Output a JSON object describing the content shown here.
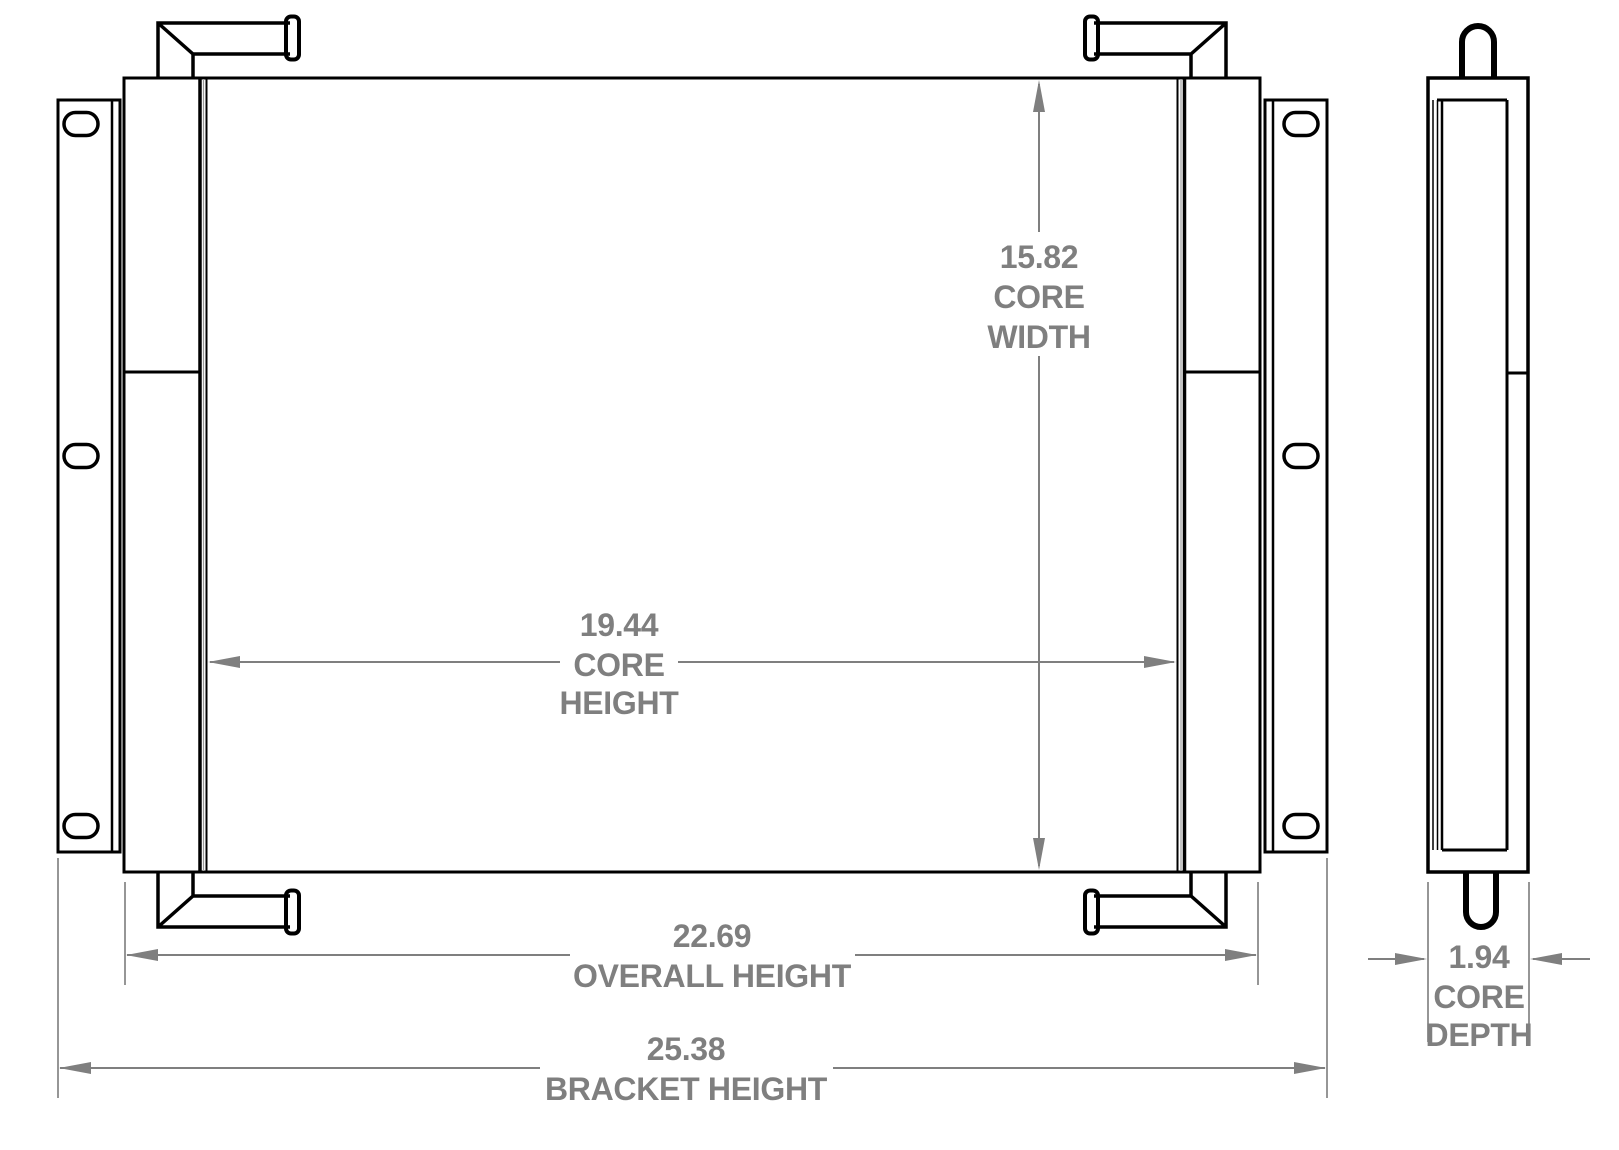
{
  "colors": {
    "background": "#ffffff",
    "drawing_lines": "#000000",
    "dimension_annotations": "#7f7f7f"
  },
  "dimensions": {
    "core_width": {
      "value": "15.82",
      "label1": "CORE",
      "label2": "WIDTH"
    },
    "core_height": {
      "value": "19.44",
      "label1": "CORE",
      "label2": "HEIGHT"
    },
    "overall_height": {
      "value": "22.69",
      "label1": "OVERALL HEIGHT"
    },
    "bracket_height": {
      "value": "25.38",
      "label1": "BRACKET HEIGHT"
    },
    "core_depth": {
      "value": "1.94",
      "label1": "CORE",
      "label2": "DEPTH"
    }
  }
}
